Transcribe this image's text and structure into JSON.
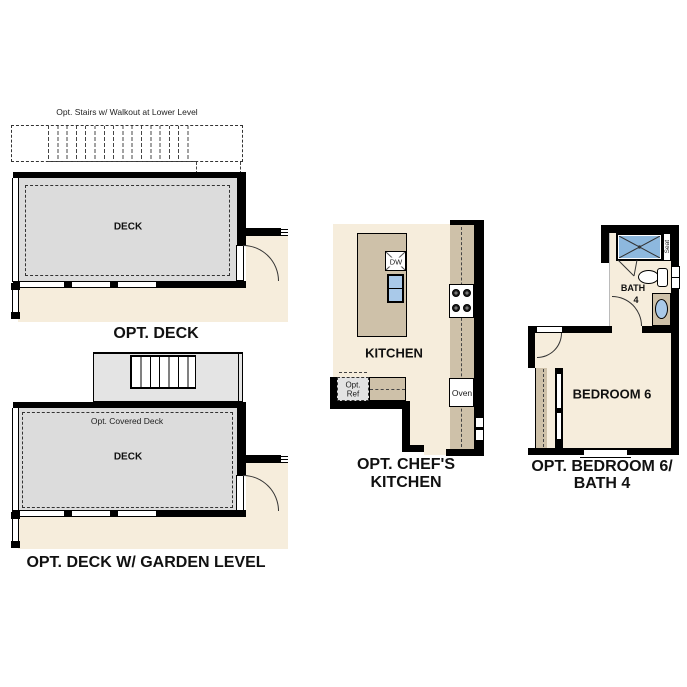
{
  "plans": {
    "opt_deck": {
      "title": "OPT. DECK",
      "stairs_label": "Opt. Stairs w/ Walkout at Lower Level",
      "room_label": "DECK"
    },
    "opt_deck_garden": {
      "title": "OPT. DECK W/ GARDEN LEVEL",
      "covered_deck_label": "Opt. Covered Deck",
      "room_label": "DECK"
    },
    "opt_chefs_kitchen": {
      "title_line1": "OPT. CHEF'S",
      "title_line2": "KITCHEN",
      "room_label": "KITCHEN",
      "dishwasher_label": "DW",
      "oven_label": "Oven",
      "fridge_label_line1": "Opt.",
      "fridge_label_line2": "Ref"
    },
    "opt_bedroom_bath": {
      "title_line1": "OPT. BEDROOM 6/",
      "title_line2": "BATH 4",
      "bedroom_label": "BEDROOM 6",
      "bath_label": "BATH",
      "bath_number": "4",
      "seat_label": "Seat"
    }
  },
  "colors": {
    "floor_beige": "#f6eddc",
    "deck_gray": "#dcdcdc",
    "stair_gray": "#e4e4e4",
    "counter_tan": "#cec1a9",
    "fixture_blue": "#a9c9e9",
    "shower_blue": "#8db8de",
    "wall_black": "#000000"
  }
}
